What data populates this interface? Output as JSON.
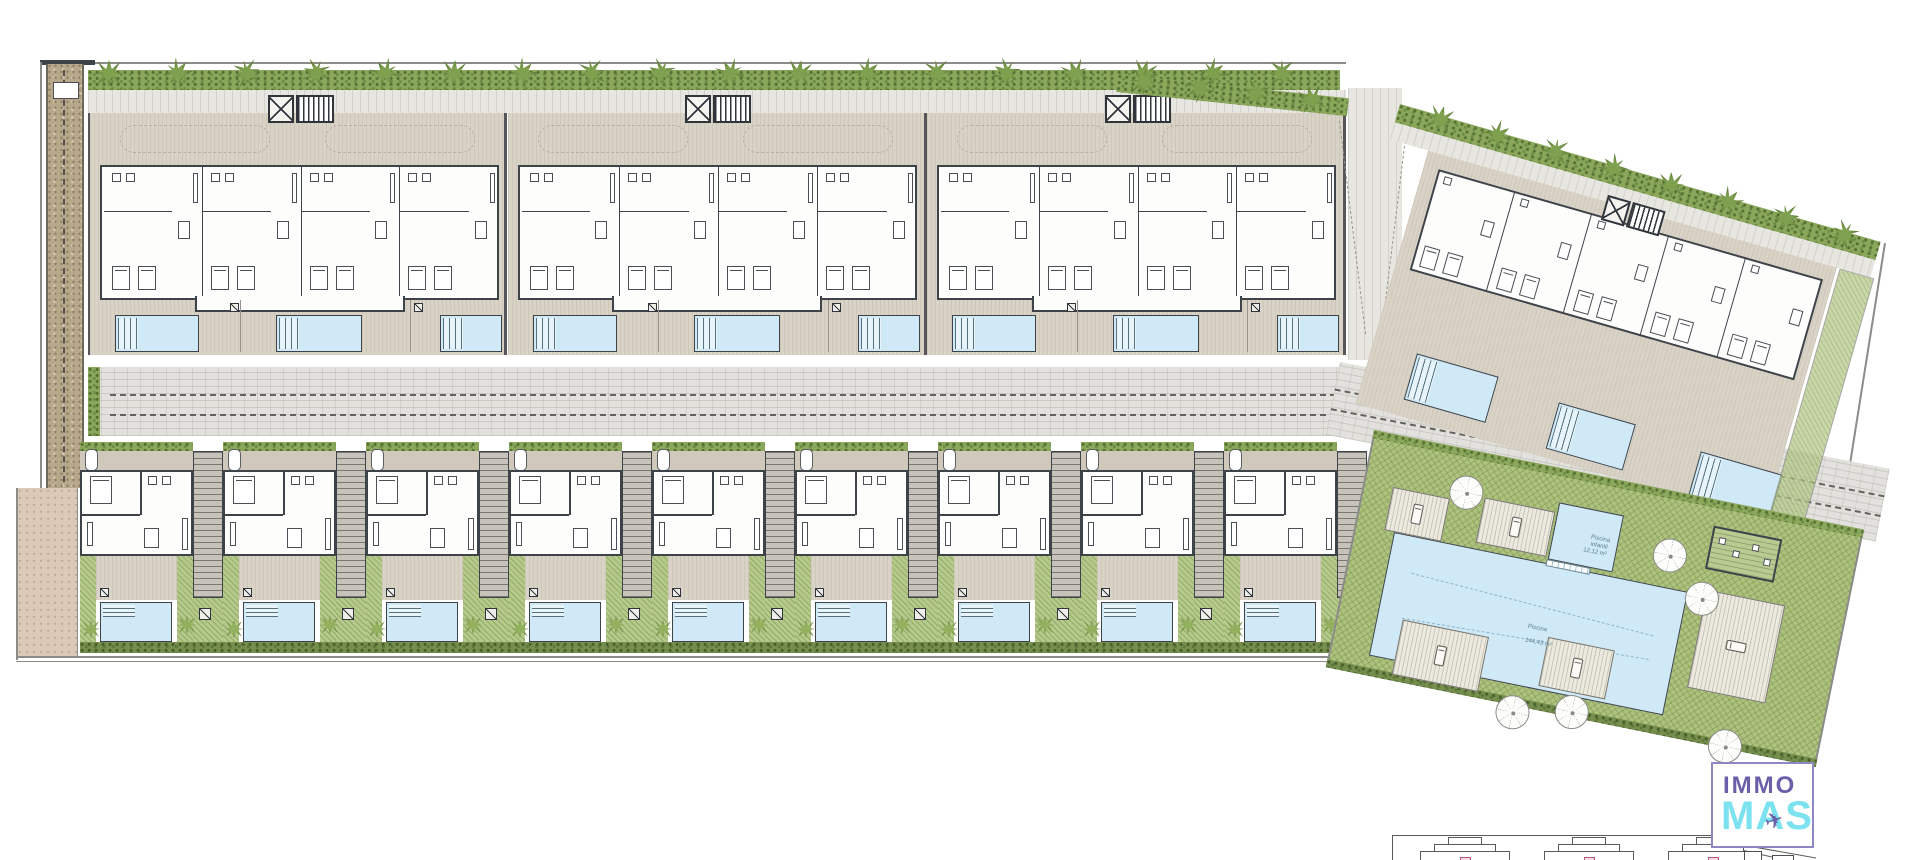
{
  "logo": {
    "line1": "IMMO",
    "line2": "MAS",
    "plane_icon": "✈"
  },
  "pool_labels": {
    "main": "Piscina",
    "main_area": "144,43 m²",
    "kids": "Piscina infantil",
    "kids_area": "12,12 m²"
  },
  "colors": {
    "wall": "#3e434a",
    "water": "#cfe9f6",
    "lawn": "#aec27f",
    "hedge": "#8aa75b",
    "tree": "#6c8f41",
    "deck": "#d9d3c7",
    "road": "#e2e1dd",
    "gravel_brown": "#b8a88b",
    "gravel_pink": "#dccab9",
    "logo_purple": "#6a5fa8",
    "logo_cyan": "#7de2ef"
  },
  "site": {
    "top_trees": {
      "count": 18,
      "x0": 96,
      "pitch": 69,
      "y": 60
    },
    "transition_trees": {
      "count": 4,
      "pitch": 56
    },
    "apartment_modules": {
      "count": 3,
      "x0": 88,
      "width": 419,
      "top": 113,
      "height": 242,
      "apartments_per_module": 4,
      "pools": [
        {
          "x": 25,
          "w": 84
        },
        {
          "x": 186,
          "w": 86
        },
        {
          "x": 350,
          "w": 62
        }
      ],
      "pool_y": 202,
      "pool_h": 37
    },
    "townhouses": {
      "count": 9,
      "x0": 80,
      "pitch": 143,
      "top": 442,
      "height": 200
    },
    "right_building": {
      "trees": 8,
      "apartments": 5,
      "pools": [
        {
          "x": 85,
          "y": 235,
          "w": 85,
          "h": 48
        },
        {
          "x": 235,
          "y": 243,
          "w": 80,
          "h": 48
        },
        {
          "x": 385,
          "y": 251,
          "w": 85,
          "h": 48
        }
      ]
    },
    "communal": {
      "parasols": [
        [
          86,
          26
        ],
        [
          298,
          47
        ],
        [
          338,
          83
        ],
        [
          175,
          232
        ],
        [
          233,
          220
        ],
        [
          390,
          223
        ]
      ],
      "decks": [
        {
          "x": 30,
          "y": 52,
          "w": 58,
          "h": 44,
          "loungers": 3,
          "dir": "h"
        },
        {
          "x": 122,
          "y": 44,
          "w": 72,
          "h": 46,
          "loungers": 3,
          "dir": "h"
        },
        {
          "x": 66,
          "y": 180,
          "w": 88,
          "h": 56,
          "loungers": 4,
          "dir": "h"
        },
        {
          "x": 212,
          "y": 168,
          "w": 68,
          "h": 50,
          "loungers": 3,
          "dir": "h"
        },
        {
          "x": 358,
          "y": 90,
          "w": 80,
          "h": 100,
          "loungers": 5,
          "dir": "v"
        }
      ]
    },
    "bottom_elevation": {
      "units": 3,
      "x0": 1420,
      "pitch": 124
    }
  }
}
